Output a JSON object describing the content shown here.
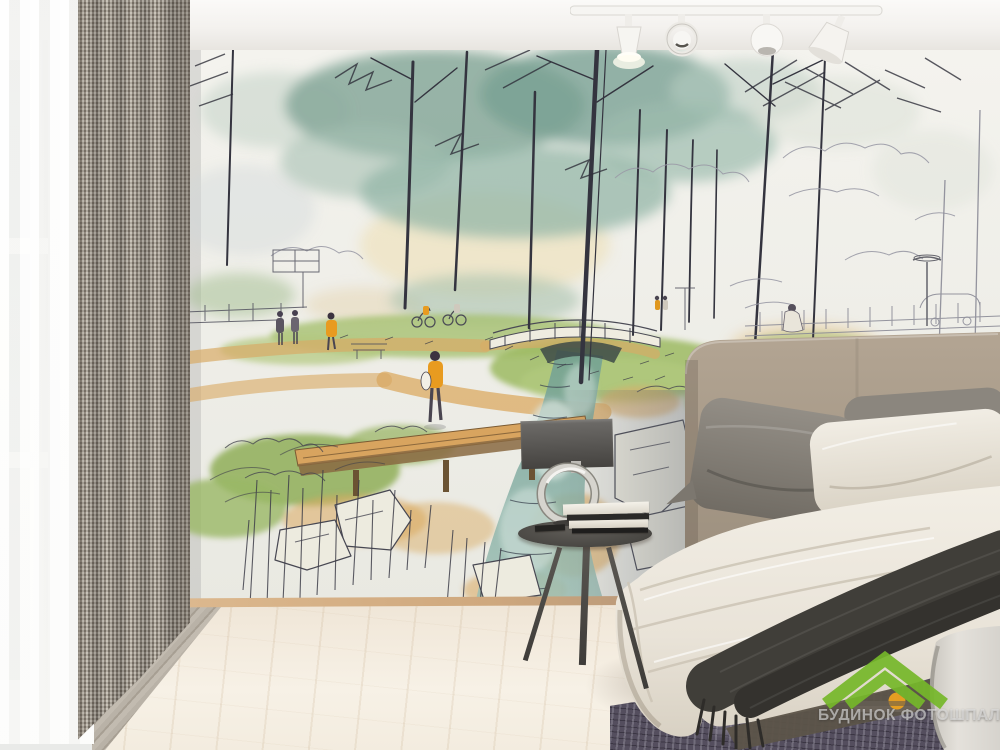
{
  "watermark": {
    "text": "БУДИНОК ФОТОШПАЛЕР",
    "logo_green": "#76b82a",
    "logo_orange": "#f0a41e",
    "logo_body": "#6e665c"
  },
  "scene": {
    "description": "Bedroom interior with a watercolor park-sketch photo wallpaper mural",
    "elements": [
      "sheer white window curtain",
      "grey woven blackout curtain",
      "wall mural: ink and watercolor park scene",
      "white ceiling track with four spotlights",
      "bed with taupe upholstered headboard",
      "grey and white pillows",
      "white duvet",
      "charcoal fringed throw blanket",
      "round gunmetal side table",
      "ring-base lamp with grey rectangular shade",
      "stack of books and magazines",
      "dark distressed area rug",
      "light wood plank floor"
    ]
  },
  "mural": {
    "subject": "park sketch in watercolor and ink",
    "features": [
      "tall trees with teal canopies",
      "winding tan path",
      "arched footbridge",
      "wooden boardwalk over stream",
      "teal stream with white boulders",
      "green lawns and bushes",
      "small figures walking and cycling",
      "street lamps, fence and distant car"
    ],
    "palette": {
      "paper": "#f2f1eb",
      "canopy_teal": "#86a89a",
      "grass_green": "#9cba62",
      "path_tan": "#d9ab66",
      "water_teal": "#6f9e94",
      "ink": "#34343f",
      "accent_orange": "#e89b20"
    }
  }
}
